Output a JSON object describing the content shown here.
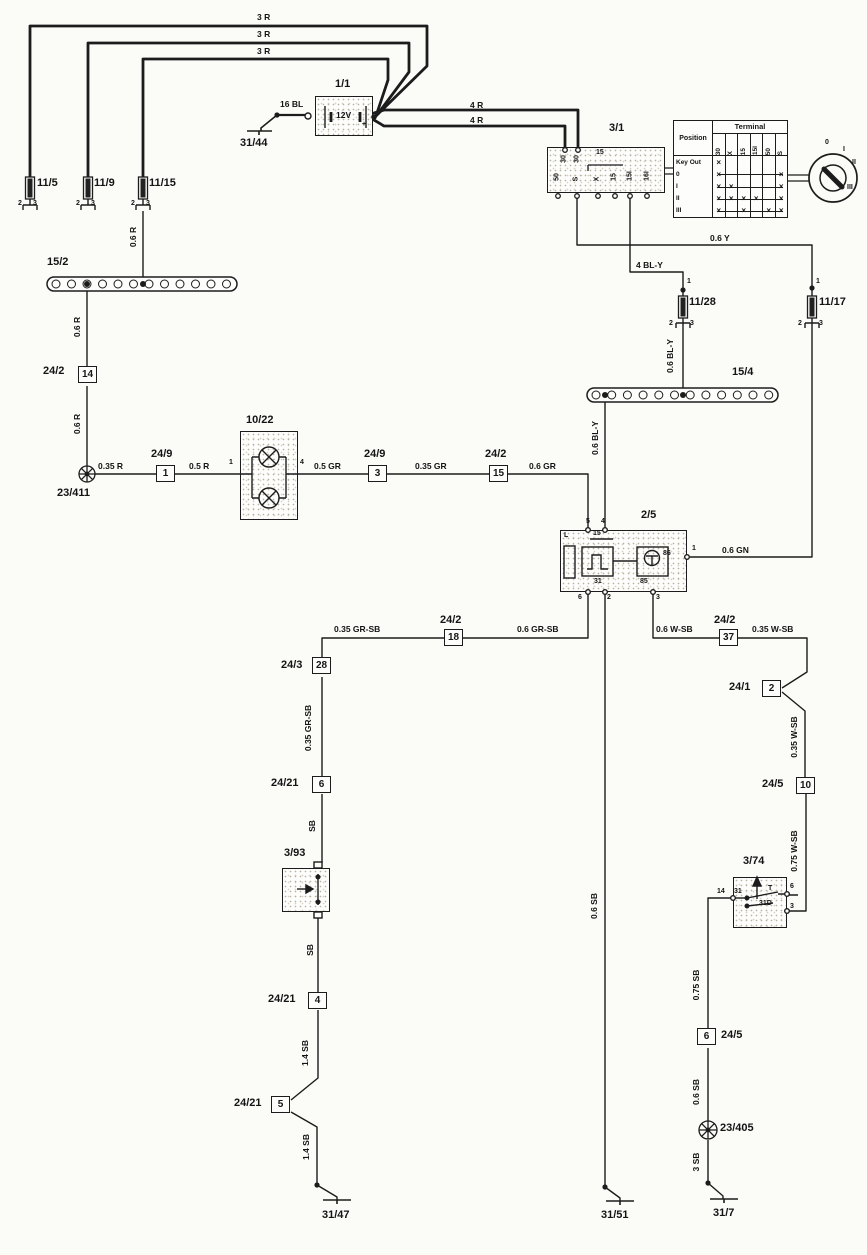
{
  "battery": {
    "voltage": "12V"
  },
  "ignition_table": {
    "position_header": "Position",
    "terminal_header": "Terminal",
    "columns": [
      "30",
      "X",
      "15",
      "15I",
      "50",
      "S"
    ],
    "rows": [
      {
        "label": "Key Out",
        "marks": [
          1,
          0,
          0,
          0,
          0,
          0
        ],
        "line": false
      },
      {
        "label": "0",
        "marks": [
          1,
          0,
          0,
          0,
          0,
          1
        ],
        "line": true
      },
      {
        "label": "I",
        "marks": [
          1,
          1,
          0,
          0,
          0,
          1
        ],
        "line": true
      },
      {
        "label": "II",
        "marks": [
          1,
          1,
          1,
          1,
          0,
          1
        ],
        "line": true
      },
      {
        "label": "III",
        "marks": [
          1,
          0,
          1,
          0,
          1,
          1
        ],
        "line": true
      }
    ]
  },
  "connector_boxes": [
    {
      "t": "14",
      "x": 78,
      "y": 366
    },
    {
      "t": "1",
      "x": 156,
      "y": 465
    },
    {
      "t": "3",
      "x": 368,
      "y": 465
    },
    {
      "t": "15",
      "x": 489,
      "y": 465
    },
    {
      "t": "18",
      "x": 444,
      "y": 629
    },
    {
      "t": "28",
      "x": 312,
      "y": 657
    },
    {
      "t": "6",
      "x": 312,
      "y": 776
    },
    {
      "t": "4",
      "x": 308,
      "y": 992
    },
    {
      "t": "5",
      "x": 271,
      "y": 1096
    },
    {
      "t": "37",
      "x": 719,
      "y": 629
    },
    {
      "t": "2",
      "x": 762,
      "y": 680
    },
    {
      "t": "10",
      "x": 796,
      "y": 777
    },
    {
      "t": "6",
      "x": 697,
      "y": 1028
    }
  ],
  "labels": {
    "component": [
      {
        "t": "1/1",
        "x": 335,
        "y": 78
      },
      {
        "t": "31/44",
        "x": 240,
        "y": 137
      },
      {
        "t": "3/1",
        "x": 609,
        "y": 122
      },
      {
        "t": "11/5",
        "x": 37,
        "y": 177
      },
      {
        "t": "11/9",
        "x": 94,
        "y": 177
      },
      {
        "t": "11/15",
        "x": 149,
        "y": 177
      },
      {
        "t": "15/2",
        "x": 47,
        "y": 256
      },
      {
        "t": "24/2",
        "x": 43,
        "y": 365
      },
      {
        "t": "23/411",
        "x": 57,
        "y": 487
      },
      {
        "t": "24/9",
        "x": 151,
        "y": 448
      },
      {
        "t": "10/22",
        "x": 246,
        "y": 414
      },
      {
        "t": "24/9",
        "x": 364,
        "y": 448
      },
      {
        "t": "24/2",
        "x": 485,
        "y": 448
      },
      {
        "t": "2/5",
        "x": 641,
        "y": 509
      },
      {
        "t": "11/28",
        "x": 689,
        "y": 296
      },
      {
        "t": "11/17",
        "x": 819,
        "y": 296
      },
      {
        "t": "15/4",
        "x": 732,
        "y": 366
      },
      {
        "t": "24/2",
        "x": 440,
        "y": 614
      },
      {
        "t": "24/3",
        "x": 281,
        "y": 659
      },
      {
        "t": "24/21",
        "x": 271,
        "y": 777
      },
      {
        "t": "3/93",
        "x": 284,
        "y": 847
      },
      {
        "t": "24/21",
        "x": 268,
        "y": 993
      },
      {
        "t": "24/21",
        "x": 234,
        "y": 1097
      },
      {
        "t": "31/47",
        "x": 322,
        "y": 1209
      },
      {
        "t": "31/51",
        "x": 601,
        "y": 1209
      },
      {
        "t": "24/2",
        "x": 714,
        "y": 614
      },
      {
        "t": "24/1",
        "x": 729,
        "y": 681
      },
      {
        "t": "24/5",
        "x": 762,
        "y": 778
      },
      {
        "t": "3/74",
        "x": 743,
        "y": 855
      },
      {
        "t": "24/5",
        "x": 721,
        "y": 1029
      },
      {
        "t": "23/405",
        "x": 720,
        "y": 1122
      },
      {
        "t": "31/7",
        "x": 713,
        "y": 1207
      }
    ],
    "wire_h": [
      {
        "t": "3 R",
        "x": 257,
        "y": 12
      },
      {
        "t": "3 R",
        "x": 257,
        "y": 29
      },
      {
        "t": "3 R",
        "x": 257,
        "y": 46
      },
      {
        "t": "16 BL",
        "x": 280,
        "y": 99
      },
      {
        "t": "4 R",
        "x": 470,
        "y": 100
      },
      {
        "t": "4 R",
        "x": 470,
        "y": 115
      },
      {
        "t": "0.6 Y",
        "x": 710,
        "y": 233
      },
      {
        "t": "4 BL-Y",
        "x": 636,
        "y": 260
      },
      {
        "t": "0.35 R",
        "x": 98,
        "y": 461
      },
      {
        "t": "0.5 R",
        "x": 189,
        "y": 461
      },
      {
        "t": "0.5 GR",
        "x": 314,
        "y": 461
      },
      {
        "t": "0.35 GR",
        "x": 415,
        "y": 461
      },
      {
        "t": "0.6 GR",
        "x": 529,
        "y": 461
      },
      {
        "t": "0.6 GN",
        "x": 722,
        "y": 545
      },
      {
        "t": "0.35 GR-SB",
        "x": 334,
        "y": 624
      },
      {
        "t": "0.6 GR-SB",
        "x": 517,
        "y": 624
      },
      {
        "t": "0.6 W-SB",
        "x": 656,
        "y": 624
      },
      {
        "t": "0.35 W-SB",
        "x": 752,
        "y": 624
      }
    ],
    "wire_v": [
      {
        "t": "0.6 R",
        "x": 133,
        "y": 237
      },
      {
        "t": "0.6 R",
        "x": 77,
        "y": 327
      },
      {
        "t": "0.6 R",
        "x": 77,
        "y": 424
      },
      {
        "t": "0.6 BL-Y",
        "x": 670,
        "y": 356
      },
      {
        "t": "0.6 BL-Y",
        "x": 595,
        "y": 438
      },
      {
        "t": "0.6 SB",
        "x": 594,
        "y": 906
      },
      {
        "t": "0.35 GR-SB",
        "x": 308,
        "y": 728
      },
      {
        "t": "SB",
        "x": 312,
        "y": 826
      },
      {
        "t": "SB",
        "x": 310,
        "y": 950
      },
      {
        "t": "1.4 SB",
        "x": 305,
        "y": 1053
      },
      {
        "t": "1.4 SB",
        "x": 306,
        "y": 1147
      },
      {
        "t": "0.35 W-SB",
        "x": 794,
        "y": 737
      },
      {
        "t": "0.75 W-SB",
        "x": 794,
        "y": 851
      },
      {
        "t": "0.75 SB",
        "x": 696,
        "y": 985
      },
      {
        "t": "0.6 SB",
        "x": 696,
        "y": 1092
      },
      {
        "t": "3 SB",
        "x": 696,
        "y": 1162
      }
    ],
    "pins": [
      {
        "t": "2",
        "x": 18,
        "y": 200
      },
      {
        "t": "3",
        "x": 33,
        "y": 200
      },
      {
        "t": "2",
        "x": 76,
        "y": 200
      },
      {
        "t": "3",
        "x": 91,
        "y": 200
      },
      {
        "t": "2",
        "x": 131,
        "y": 200
      },
      {
        "t": "3",
        "x": 146,
        "y": 200
      },
      {
        "t": "1",
        "x": 687,
        "y": 278
      },
      {
        "t": "2",
        "x": 669,
        "y": 320
      },
      {
        "t": "3",
        "x": 690,
        "y": 320
      },
      {
        "t": "1",
        "x": 816,
        "y": 278
      },
      {
        "t": "2",
        "x": 798,
        "y": 320
      },
      {
        "t": "3",
        "x": 819,
        "y": 320
      },
      {
        "t": "1",
        "x": 229,
        "y": 459
      },
      {
        "t": "4",
        "x": 300,
        "y": 459
      },
      {
        "t": "5",
        "x": 586,
        "y": 518
      },
      {
        "t": "4",
        "x": 601,
        "y": 518
      },
      {
        "t": "1",
        "x": 692,
        "y": 545
      },
      {
        "t": "6",
        "x": 578,
        "y": 594
      },
      {
        "t": "2",
        "x": 607,
        "y": 594
      },
      {
        "t": "3",
        "x": 656,
        "y": 594
      },
      {
        "t": "L",
        "x": 564,
        "y": 532
      },
      {
        "t": "15",
        "x": 593,
        "y": 530
      },
      {
        "t": "86",
        "x": 663,
        "y": 550
      },
      {
        "t": "31",
        "x": 594,
        "y": 578
      },
      {
        "t": "85",
        "x": 640,
        "y": 578
      },
      {
        "t": "15",
        "x": 596,
        "y": 149
      },
      {
        "t": "14",
        "x": 717,
        "y": 888
      },
      {
        "t": "31",
        "x": 734,
        "y": 888
      },
      {
        "t": "T",
        "x": 768,
        "y": 885
      },
      {
        "t": "31D",
        "x": 759,
        "y": 900
      },
      {
        "t": "6",
        "x": 790,
        "y": 883
      },
      {
        "t": "3",
        "x": 790,
        "y": 903
      },
      {
        "t": "+",
        "x": 362,
        "y": 121
      }
    ],
    "pins_rot": [
      {
        "t": "30",
        "x": 564,
        "y": 159
      },
      {
        "t": "30",
        "x": 577,
        "y": 159
      },
      {
        "t": "50",
        "x": 557,
        "y": 177
      },
      {
        "t": "S",
        "x": 576,
        "y": 179
      },
      {
        "t": "X",
        "x": 597,
        "y": 179
      },
      {
        "t": "15",
        "x": 614,
        "y": 177
      },
      {
        "t": "15I",
        "x": 630,
        "y": 176
      },
      {
        "t": "16I",
        "x": 647,
        "y": 176
      }
    ],
    "key_positions": [
      {
        "t": "0",
        "x": 825,
        "y": 139
      },
      {
        "t": "I",
        "x": 843,
        "y": 146
      },
      {
        "t": "II",
        "x": 852,
        "y": 159
      },
      {
        "t": "III",
        "x": 847,
        "y": 184
      }
    ]
  }
}
